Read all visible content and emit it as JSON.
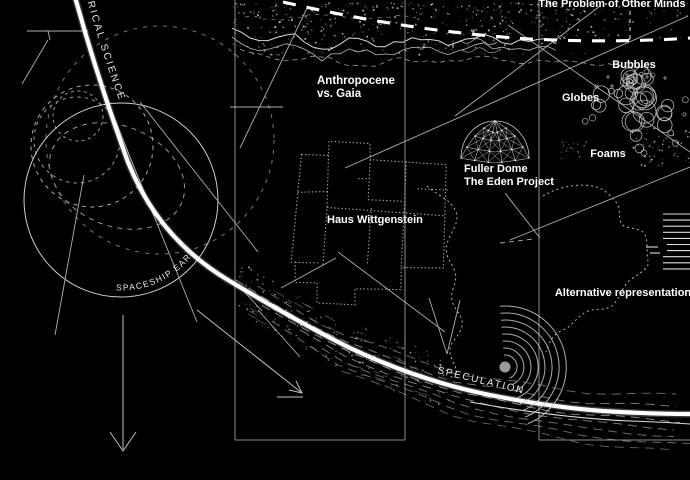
{
  "colors": {
    "background": "#000000",
    "ink": "#ffffff",
    "dim_line": "#9a9a9a"
  },
  "labels": {
    "science_arc": "RICAL SCIENCE",
    "problem_of_other_minds": "The Problem of Other Minds",
    "anthropocene_1": "Anthropocene",
    "anthropocene_2": "vs. Gaia",
    "bubbles": "Bubbles",
    "globes": "Globes",
    "foams": "Foams",
    "fuller_1": "Fuller Dome",
    "fuller_2": "The Eden Project",
    "haus_wittgenstein": "Haus Wittgenstein",
    "alternative_representation": "Alternative representation",
    "spaceship_earth": "SPACESHIP EARTH",
    "speculation": "SPECULATION"
  }
}
